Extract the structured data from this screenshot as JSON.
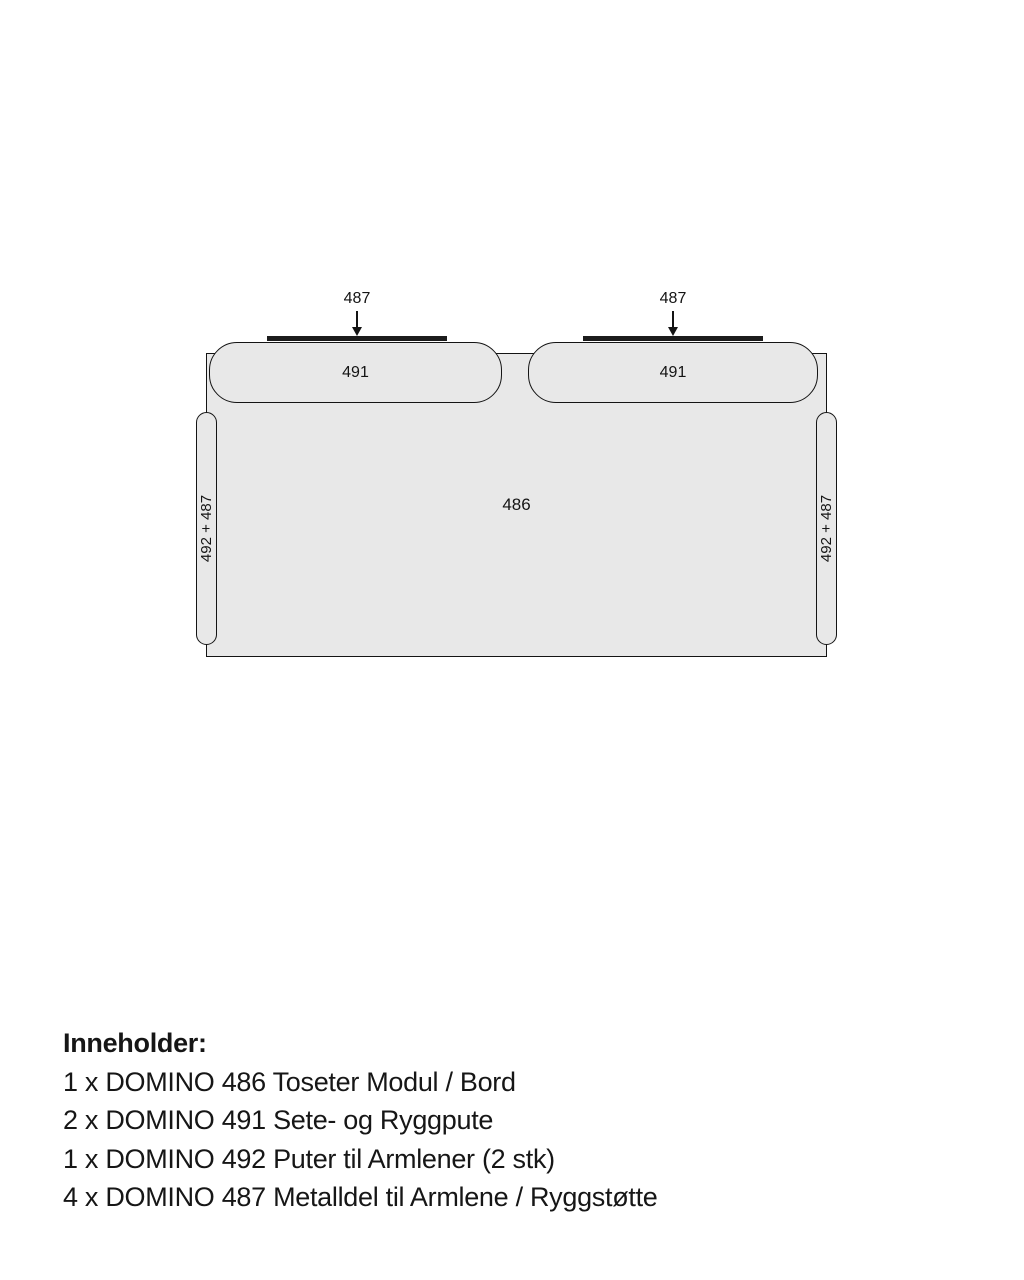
{
  "diagram": {
    "labels": {
      "metal_left": "487",
      "metal_right": "487",
      "cushion_left": "491",
      "cushion_right": "491",
      "base": "486",
      "armrest_left": "492 + 487",
      "armrest_right": "492 + 487"
    },
    "colors": {
      "fill": "#e8e8e8",
      "outline": "#141414",
      "metal_bar": "#1c1c1c",
      "background": "#ffffff"
    }
  },
  "contents": {
    "heading": "Inneholder:",
    "items": [
      "1 x DOMINO 486 Toseter Modul / Bord",
      "2 x DOMINO 491 Sete- og Ryggpute",
      "1 x DOMINO 492 Puter til Armlener (2 stk)",
      "4 x DOMINO 487 Metalldel til Armlene / Ryggstøtte"
    ]
  }
}
